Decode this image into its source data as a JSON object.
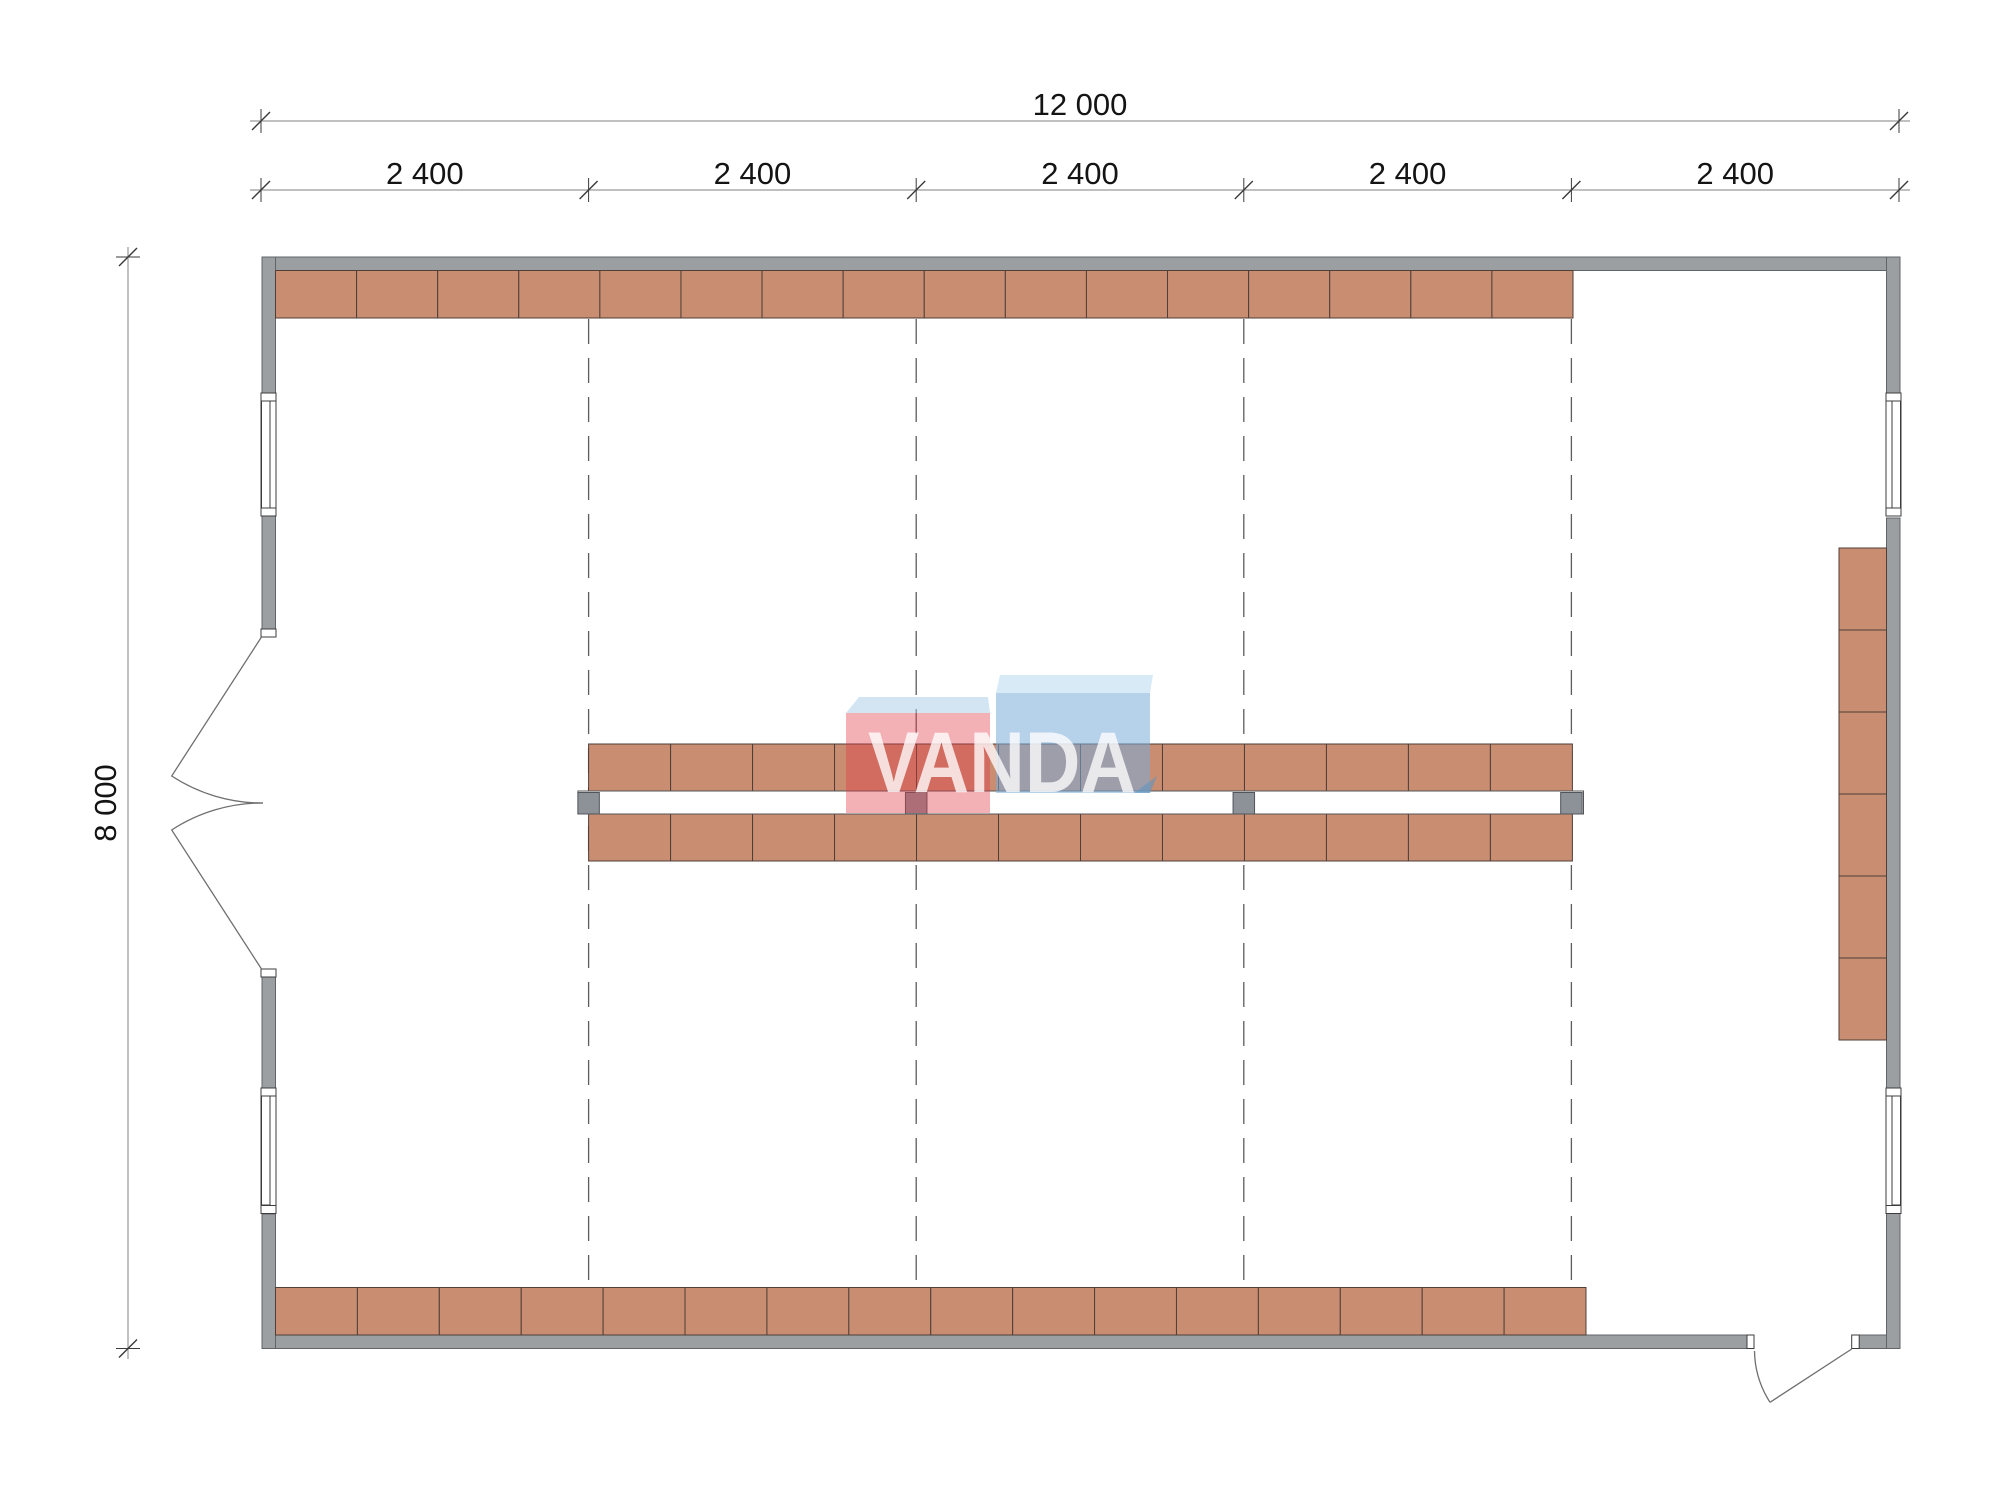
{
  "title": "Floor plan 12000 x 8000 with pallet racking",
  "watermark": {
    "text": "VANDA"
  },
  "dimensions": {
    "overall": {
      "label": "12 000",
      "y": 121,
      "x1": 250,
      "x2": 1910,
      "ticks": [
        261,
        1899
      ],
      "label_x": 1080,
      "label_y": 115
    },
    "bays": {
      "y": 190,
      "x1": 250,
      "x2": 1910,
      "ticks": [
        261,
        588.6,
        916.2,
        1243.8,
        1571.4,
        1899
      ],
      "labels": [
        "2 400",
        "2 400",
        "2 400",
        "2 400",
        "2 400"
      ],
      "label_centers": [
        424.8,
        752.4,
        1080,
        1407.6,
        1735.2
      ],
      "label_y": 184
    },
    "height": {
      "label": "8 000",
      "x": 128,
      "y1": 247,
      "y2": 1359,
      "ticks": [
        257,
        1348.5
      ],
      "label_x": 116,
      "label_y": 803
    }
  },
  "floor_plan": {
    "units": "mm",
    "overall_width_mm": 12000,
    "overall_height_mm": 8000,
    "bay_width_mm": 2400,
    "grid_lines": {
      "x": [
        588.6,
        916.2,
        1243.8,
        1571.4
      ],
      "y_top": 319,
      "y_bottom": 1287
    },
    "shelves": [
      {
        "name": "top-wall-rack",
        "x": 275.5,
        "y": 270.5,
        "w": 1297.5,
        "h": 47.5,
        "segments": 16,
        "dir": "h"
      },
      {
        "name": "bottom-wall-rack",
        "x": 275.5,
        "y": 1287.5,
        "w": 1310.5,
        "h": 47.5,
        "segments": 16,
        "dir": "h"
      },
      {
        "name": "center-rack-north",
        "x": 588.6,
        "y": 744,
        "w": 983.8,
        "h": 48,
        "segments": 12,
        "dir": "h"
      },
      {
        "name": "center-rack-south",
        "x": 588.6,
        "y": 814,
        "w": 983.8,
        "h": 47,
        "segments": 12,
        "dir": "h"
      },
      {
        "name": "right-wall-rack",
        "x": 1839,
        "y": 548,
        "w": 47.5,
        "h": 492,
        "segments": 6,
        "dir": "v"
      }
    ],
    "columns": {
      "x": [
        588.6,
        916.2,
        1243.8,
        1571.4
      ],
      "y": 792.5,
      "size": 21.5
    },
    "aisle": {
      "x": 578,
      "y": 791,
      "w": 1005.5,
      "h": 23
    }
  },
  "colors": {
    "wall_fill": "#9b9fa2",
    "wall_stroke": "#60656a",
    "shelf_fill": "#c98d72",
    "shelf_stroke": "#4f3f37",
    "column_fill": "#8c9298",
    "column_stroke": "#50565c",
    "aisle_stroke": "#555555",
    "grid_stroke": "#5c5c5c",
    "dim_line": "#9a9a9a",
    "tick_stroke": "#3a3a3a",
    "dim_text": "#141414",
    "door_stroke": "#6f6f6f",
    "window_stroke": "#3c3c3c",
    "wm_pink": "rgba(224,58,70,0.40)",
    "wm_pink_top": "rgba(168,203,232,0.50)",
    "wm_blue": "rgba(122,172,216,0.55)",
    "wm_blue_top": "rgba(186,217,240,0.55)",
    "wm_fold": "rgba(96,148,190,0.60)",
    "wm_text": "#ffffff"
  }
}
